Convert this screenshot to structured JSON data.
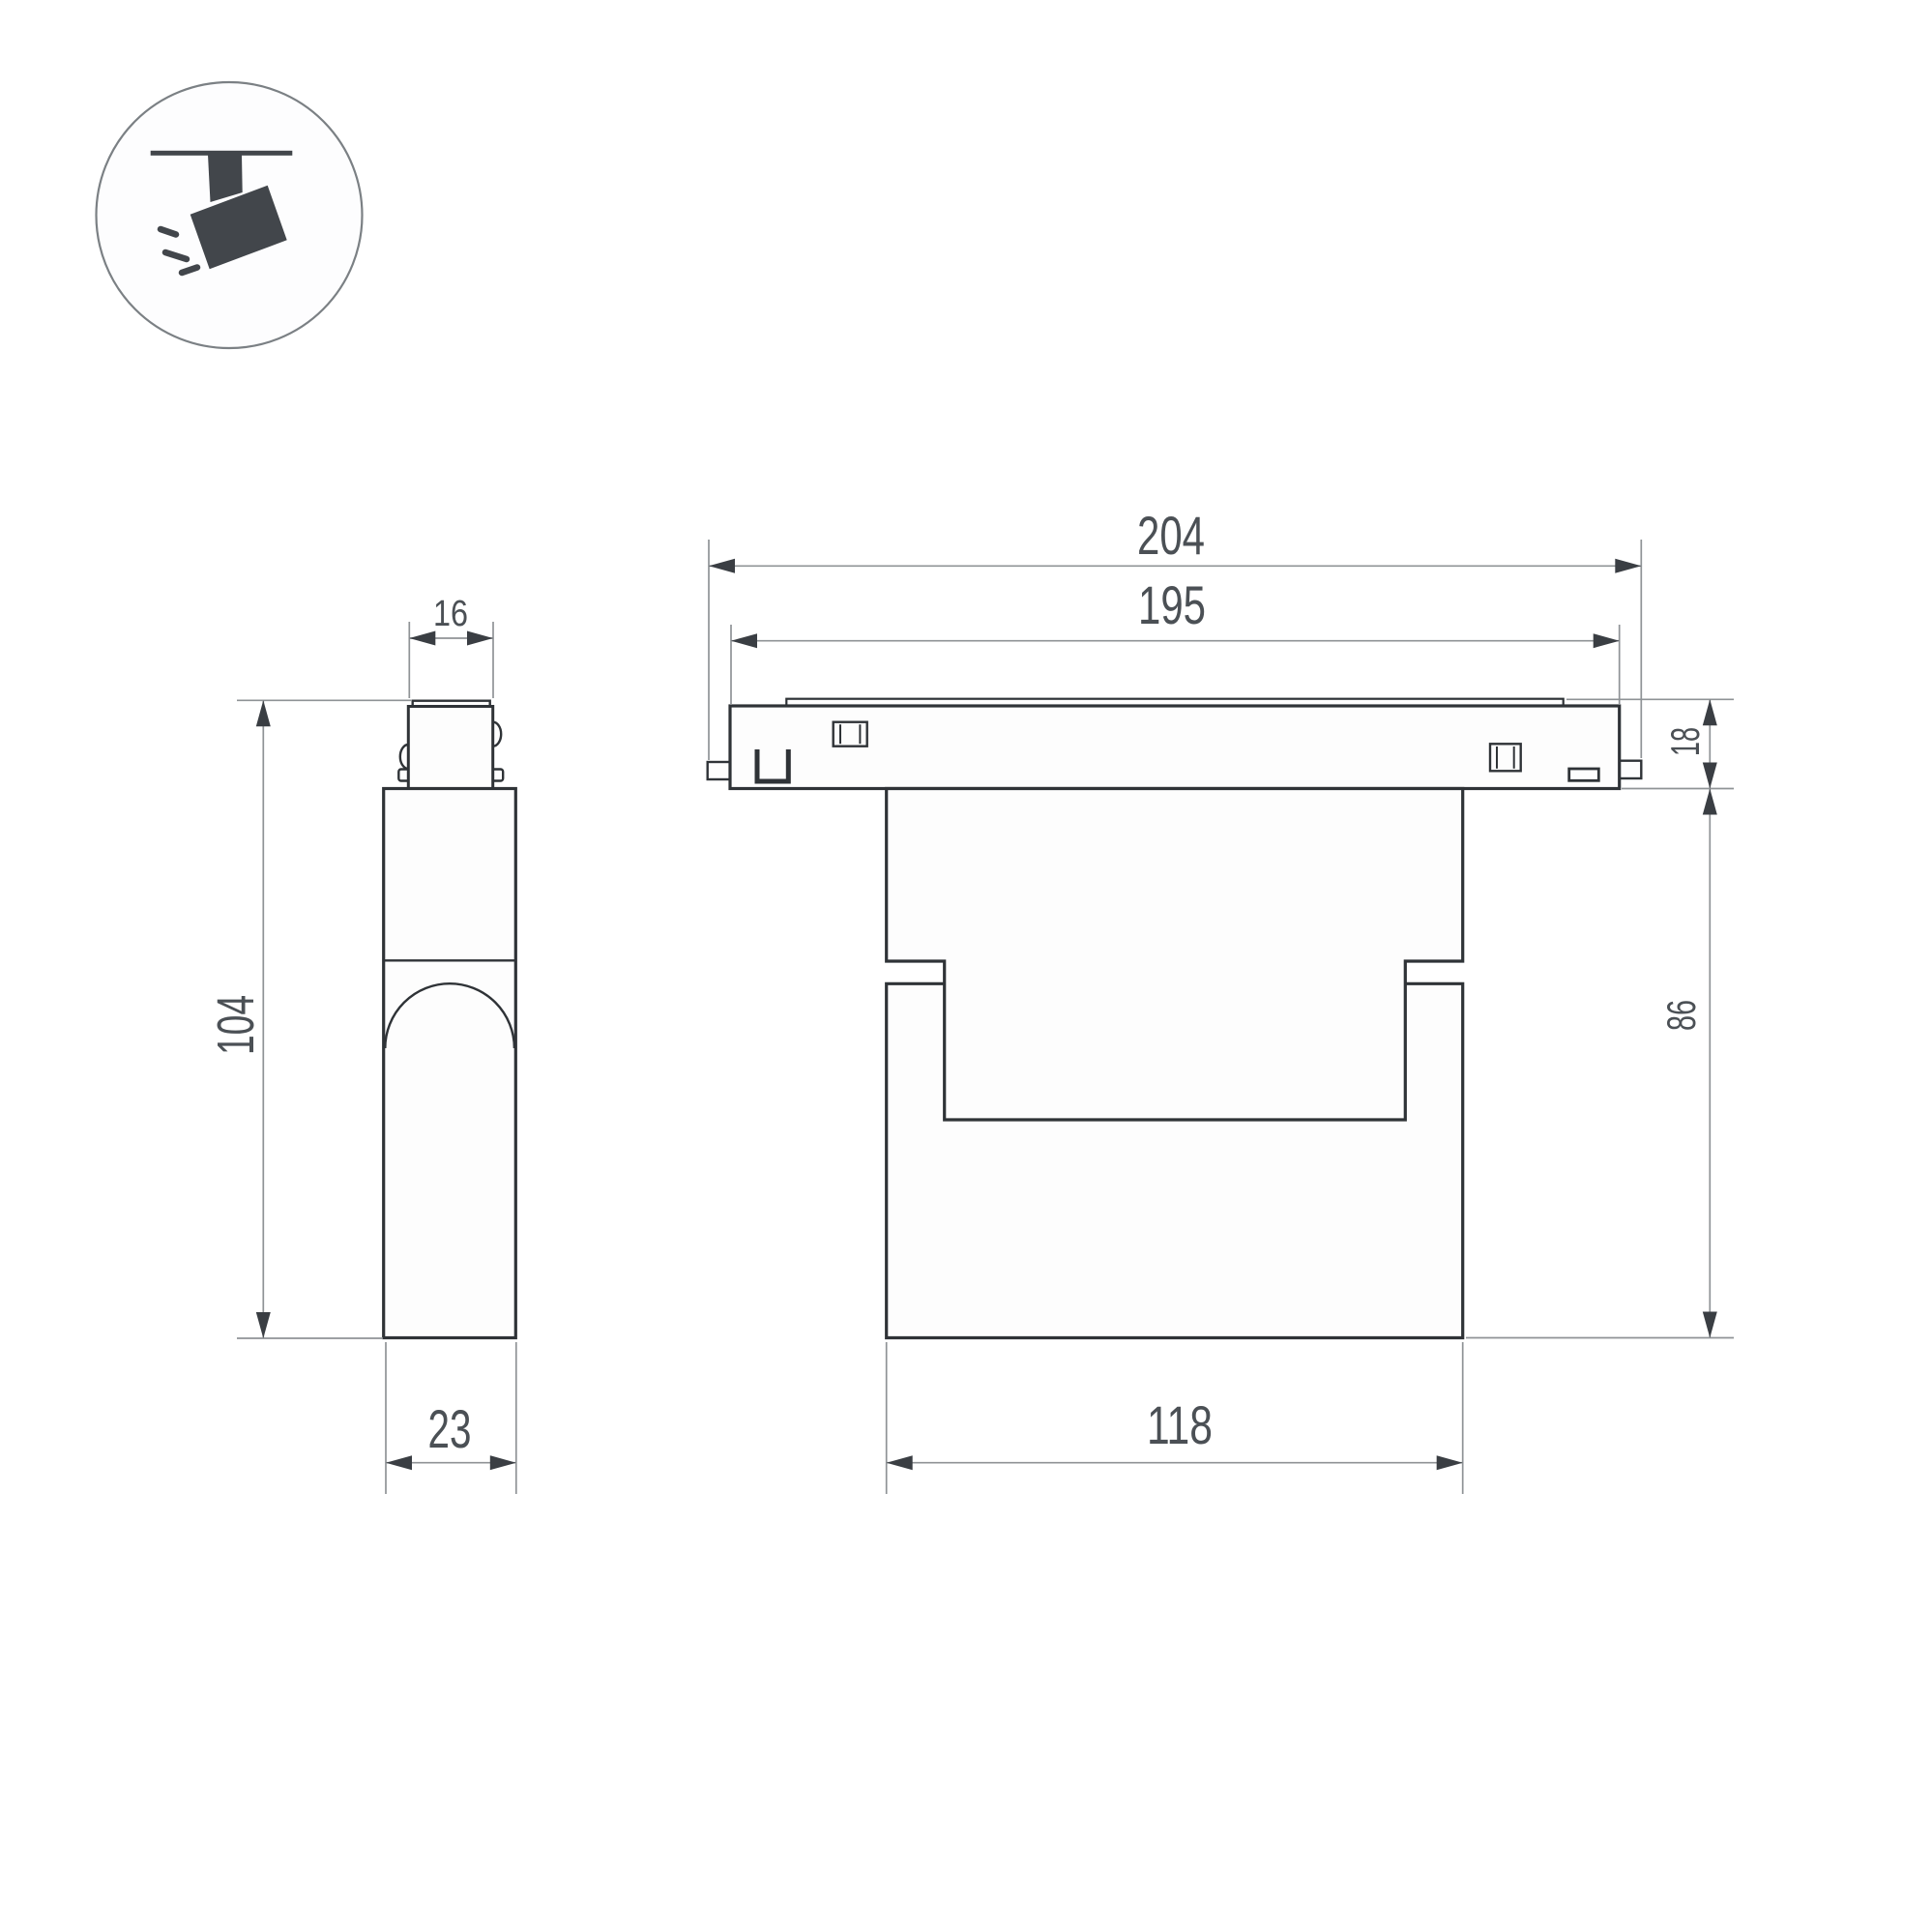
{
  "drawing": {
    "colors": {
      "outline": "#2f3337",
      "dimension_line": "#8f9396",
      "dimension_text": "#4b5055",
      "icon": "#42464b",
      "background": "#ffffff"
    },
    "icon": {
      "kind": "track-spotlight"
    },
    "side_view": {
      "connector_width": "16",
      "overall_height": "104",
      "depth": "23"
    },
    "front_view": {
      "overall_length": "204",
      "track_body_length": "195",
      "track_height": "18",
      "body_height": "86",
      "lamp_body_width": "118"
    }
  }
}
